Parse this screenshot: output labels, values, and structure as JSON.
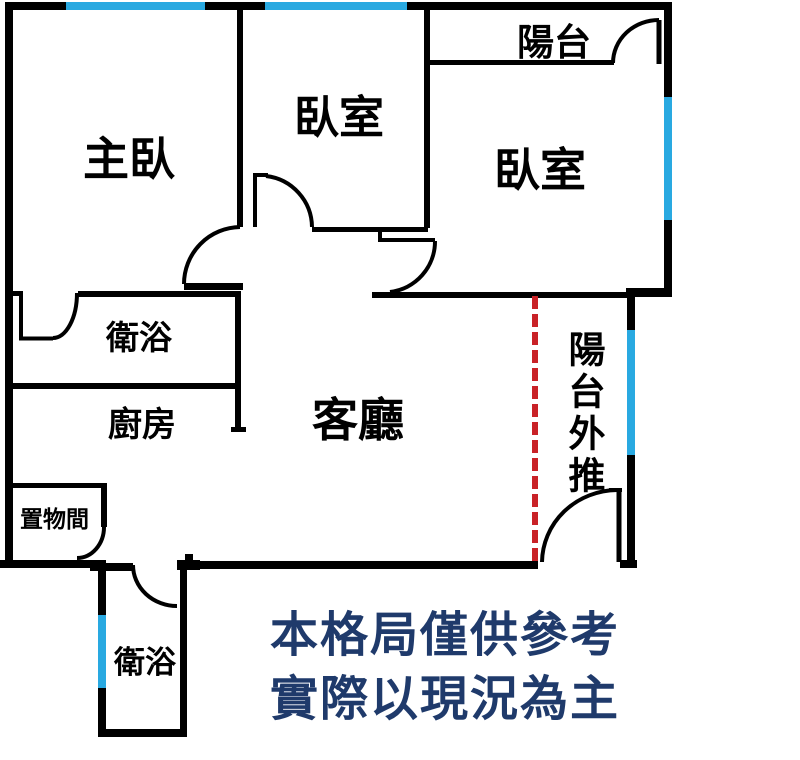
{
  "plan": {
    "title": "apartment-floor-plan",
    "rooms": {
      "master_bedroom": "主臥",
      "bedroom_mid": "臥室",
      "bedroom_right": "臥室",
      "balcony": "陽台",
      "bathroom_upper": "衛浴",
      "kitchen": "廚房",
      "living_room": "客廳",
      "storage": "置物間",
      "bathroom_lower": "衛浴",
      "balcony_extension": "陽台外推"
    },
    "disclaimer": {
      "line1": "本格局僅供參考",
      "line2": "實際以現況為主"
    },
    "markers": {
      "window_marker": "blue-window-segment",
      "removed_wall_marker": "red-dashed-line",
      "door_marker": "quarter-arc-door-swing"
    }
  },
  "colors": {
    "wall": "#000000",
    "window_blue": "#29A9E1",
    "dashed_red": "#C92227",
    "disclaimer_navy": "#1F3A6B",
    "background": "#FFFFFF"
  }
}
